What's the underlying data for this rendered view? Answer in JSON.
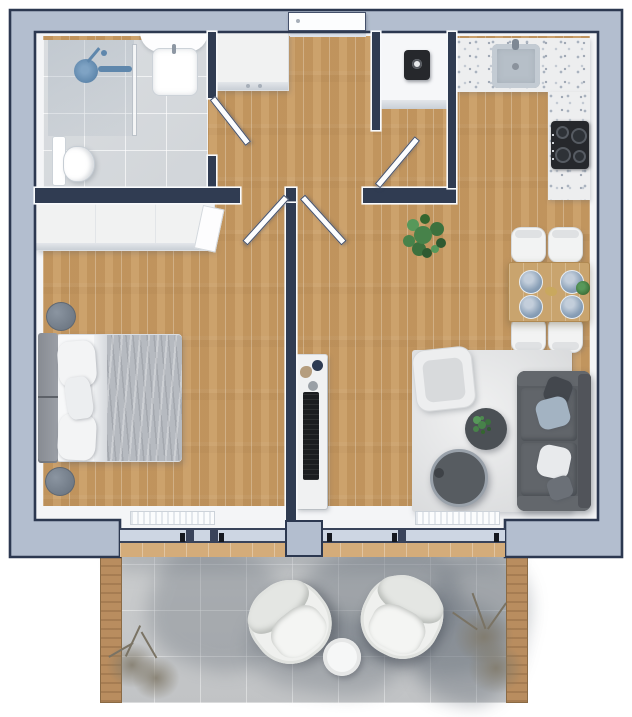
{
  "meta": {
    "kind": "apartment-floor-plan-rendering",
    "view": "top-down-3d",
    "has_text": false
  },
  "palette": {
    "wall-fill": "#b3becf",
    "wall-line": "#2c3850",
    "partition": "#303c52",
    "wood": "#c89b63",
    "wood-light": "#d4ac7a",
    "tile": "#d7dadd",
    "terrazzo": "#edeeef",
    "rug": "#e2e3e4",
    "balcony-tile": "#c7c9cb",
    "screen-wood": "#b98d5f",
    "sofa": "#595d62",
    "pillow-blue": "#a3b3c2",
    "plate-blue": "#8fa5bb",
    "plant-green": "#3f7a42",
    "appliance-dark": "#26282c",
    "furniture-white": "#f1f2f2",
    "glass-blue": "#cdd6e3",
    "bed-blanket": "#b6bac0",
    "headboard": "#90949b",
    "nightstand": "#78828e",
    "door-white": "#fcfdfe",
    "gold": "#c9a85e"
  },
  "rooms": {
    "bathroom": {
      "name": "bathroom",
      "floor": "grey-tile",
      "fixtures": [
        "walk-in-shower",
        "shower-glass-panel",
        "washbasin",
        "toilet"
      ]
    },
    "hallway": {
      "name": "entry-hall",
      "floor": "wood",
      "furniture": [
        "entry-cabinet"
      ],
      "doors": [
        "entrance-door",
        "bathroom-door",
        "bedroom-door",
        "living-room-door",
        "closet-door"
      ]
    },
    "utility_closet": {
      "name": "utility-closet",
      "floor": "wood+shelf",
      "appliances": [
        "water-heater"
      ]
    },
    "kitchen": {
      "name": "kitchen",
      "floor": "wood",
      "features": [
        "top-counter",
        "right-counter"
      ],
      "appliances": [
        "sink",
        "cooktop-4-burners"
      ],
      "dining": {
        "table": "wood-dining-table",
        "items": [
          {
            "item": "dining-chair",
            "qty": 4
          },
          {
            "item": "blue-plate",
            "qty": 4
          },
          {
            "item": "gold-centerpiece",
            "qty": 1
          },
          {
            "item": "table-plant",
            "qty": 1
          }
        ]
      }
    },
    "bedroom": {
      "name": "bedroom",
      "floor": "wood",
      "furniture": [
        "built-in-wardrobe",
        "double-bed",
        "headboard",
        {
          "item": "white-pillow",
          "qty": 2
        },
        {
          "item": "accent-pillow",
          "qty": 1
        },
        {
          "item": "round-nightstand",
          "qty": 2
        }
      ]
    },
    "living_room": {
      "name": "living-room",
      "floor": "wood",
      "furniture": [
        "area-rug",
        "sofa",
        {
          "item": "sofa-pillow",
          "qty": 4
        },
        "armchair",
        "coffee-table-small-with-plant",
        "coffee-table-large",
        "tv-unit",
        "potted-floor-plant"
      ]
    },
    "balcony": {
      "name": "balcony",
      "floor": "grey-tile",
      "furniture": [
        {
          "item": "lounge-chair",
          "qty": 2
        },
        "round-side-table",
        {
          "item": "dried-plant",
          "qty": 2
        },
        {
          "item": "wood-privacy-screen",
          "qty": 2
        }
      ]
    }
  },
  "openings": {
    "windows": [
      "bedroom-window-wall",
      "living-room-window-wall"
    ],
    "radiators": 2,
    "entrance": "top-center"
  }
}
